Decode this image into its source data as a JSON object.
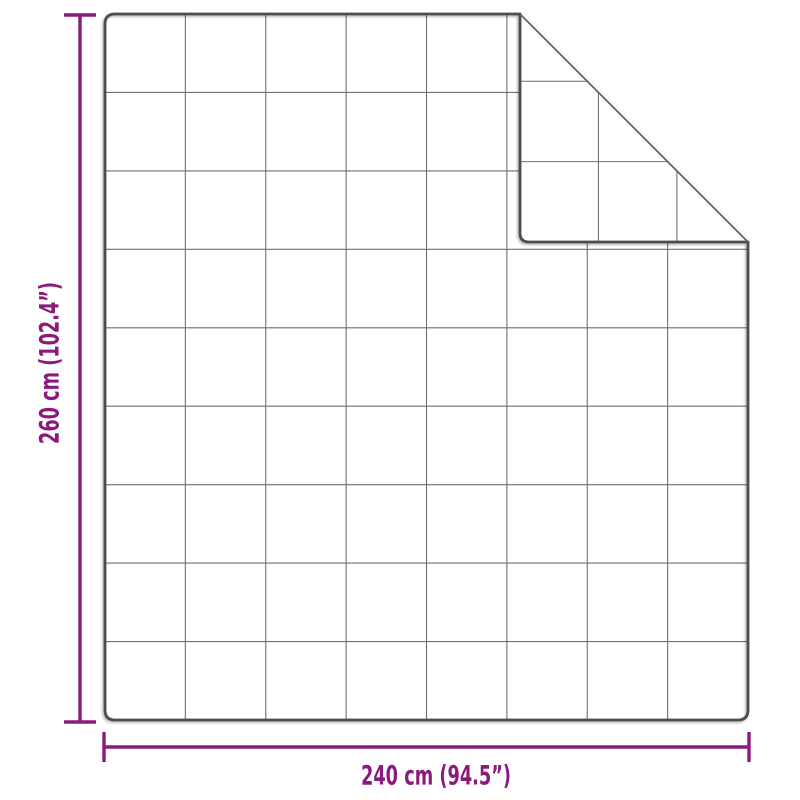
{
  "diagram": {
    "vertical_dimension": {
      "label": "260 cm (102.4”)"
    },
    "horizontal_dimension": {
      "label": "240 cm (94.5”)"
    },
    "grid": {
      "columns": 8,
      "rows": 9
    },
    "colors": {
      "dimension_accent": "#8b1a7d",
      "outline": "#4d4d4d",
      "grid_line": "#6f6f6f",
      "fabric_fill": "#ffffff",
      "background": "#ffffff"
    }
  }
}
